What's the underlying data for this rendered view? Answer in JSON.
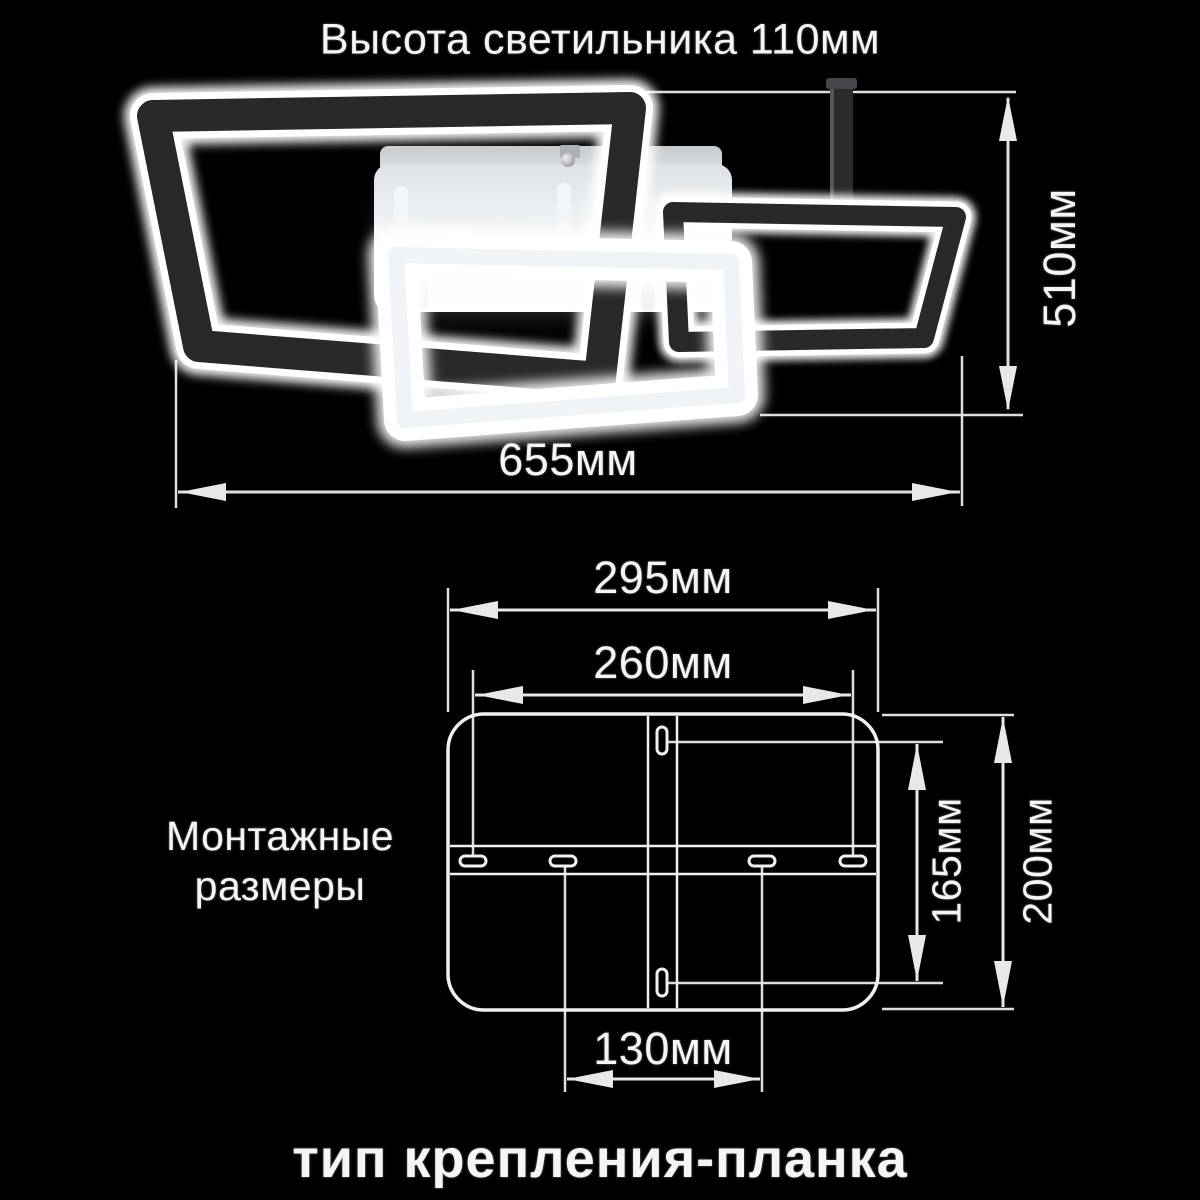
{
  "colors": {
    "background": "#000000",
    "line": "#e3e3e3",
    "text": "#f5f5f5"
  },
  "top_section": {
    "title": "Высота светильника 110мм",
    "width_dimension": "655мм",
    "height_dimension": "510мм"
  },
  "mounting_section": {
    "caption_line1": "Монтажные",
    "caption_line2": "размеры",
    "plate_width": "295мм",
    "holes_span_width": "260мм",
    "holes_span_height": "165мм",
    "plate_height": "200мм",
    "center_holes_span": "130мм"
  },
  "footer": {
    "mount_type": "тип крепления-планка"
  }
}
